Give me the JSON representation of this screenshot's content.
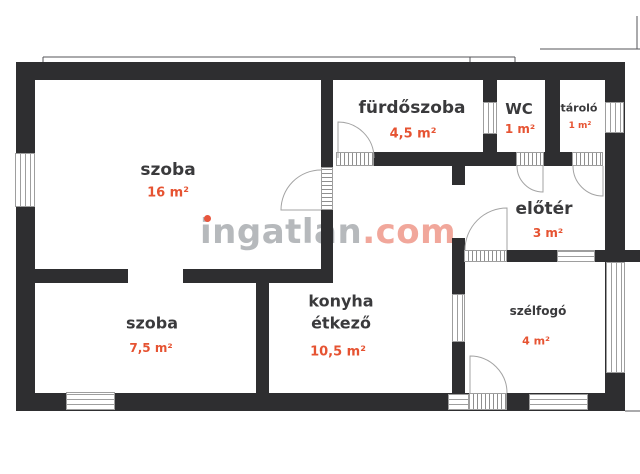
{
  "plan_title": "lakás alaprajz",
  "watermark": {
    "main": "ingatlan",
    "suffix": ".com"
  },
  "rooms": [
    {
      "id": "szoba-16",
      "label": "szoba",
      "area": "16 m²"
    },
    {
      "id": "furdoszoba",
      "label": "fürdőszoba",
      "area": "4,5 m²"
    },
    {
      "id": "wc",
      "label": "WC",
      "area": "1 m²"
    },
    {
      "id": "tarolo",
      "label": "tároló",
      "area": "1 m²"
    },
    {
      "id": "eloter",
      "label": "előtér",
      "area": "3 m²"
    },
    {
      "id": "szoba-75",
      "label": "szoba",
      "area": "7,5 m²"
    },
    {
      "id": "konyha",
      "label_lines": [
        "konyha",
        "étkező"
      ],
      "area": "10,5 m²"
    },
    {
      "id": "szelfogo",
      "label": "szélfogó",
      "area": "4 m²"
    }
  ],
  "colors": {
    "wall": "#2e2e30",
    "room_label": "#3a3a3c",
    "area_value": "#e65332",
    "watermark_gray": "#b6b9bc",
    "watermark_com": "#f1a79b",
    "watermark_dot": "#e8563d"
  }
}
